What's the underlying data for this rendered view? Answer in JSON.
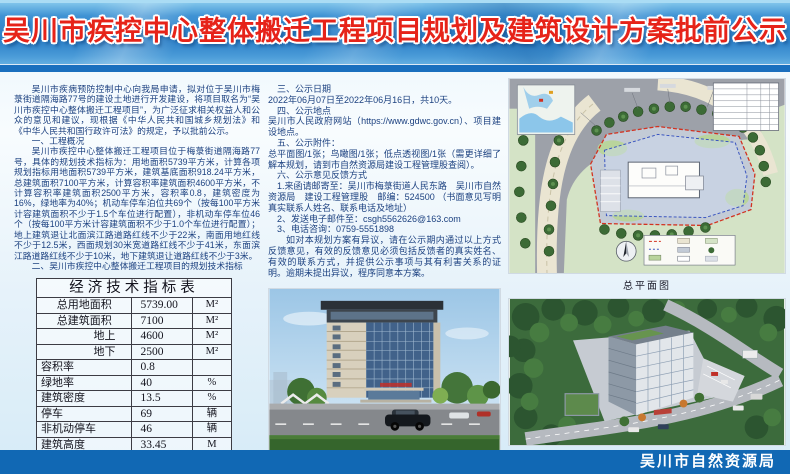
{
  "header": {
    "title": "吴川市疾控中心整体搬迁工程项目规划及建筑设计方案批前公示"
  },
  "left": {
    "intro": "吴川市疾病预防控制中心向我局申请，拟对位于吴川市梅菉街道隔海路77号的建设土地进行开发建设，将项目取名为“吴川市疾控中心整体搬迁工程项目”，为广泛征求相关权益人和公众的意见和建议，现根据《中华人民共和国城乡规划法》和《中华人民共和国行政许可法》的规定，予以批前公示。",
    "s1_heading": "一、工程概况",
    "s1_body": "吴川市疾控中心整体搬迁工程项目位于梅菉街道隔海路77号，具体的规划技术指标为：用地面积5739平方米，计算各项规划指标用地面积5739平方米，建筑基底面积918.24平方米，总建筑面积7100平方米，计算容积率建筑面积4600平方米，不计算容积率建筑面积2500平方米，容积率0.8，建筑密度为16%，绿地率为40%；机动车停车泊位共69个（按每100平方米计容建筑面积不少于1.5个车位进行配置），非机动车停车位46个（按每100平方米计容建筑面积不少于1.0个车位进行配置）；地上建筑退让北面滨江路道路红线不少于22米，南面用地红线不少于12.5米，西面规划30米宽道路红线不少于41米，东面滨江路道路红线不少于10米，地下建筑退让道路红线不少于3米。",
    "s2_heading": "二、吴川市疾控中心整体搬迁工程项目的规划技术指标",
    "table": {
      "title": "经济技术指标表",
      "rows": [
        {
          "label": "总用地面积",
          "value": "5739.00",
          "unit": "M²"
        },
        {
          "label": "总建筑面积",
          "value": "7100",
          "unit": "M²"
        },
        {
          "label": "地上",
          "value": "4600",
          "unit": "M²"
        },
        {
          "label": "地下",
          "value": "2500",
          "unit": "M²"
        },
        {
          "label": "容积率",
          "value": "0.8",
          "unit": ""
        },
        {
          "label": "绿地率",
          "value": "40",
          "unit": "%"
        },
        {
          "label": "建筑密度",
          "value": "13.5",
          "unit": "%"
        },
        {
          "label": "停车",
          "value": "69",
          "unit": "辆"
        },
        {
          "label": "非机动停车",
          "value": "46",
          "unit": "辆"
        },
        {
          "label": "建筑高度",
          "value": "33.45",
          "unit": "M"
        }
      ]
    }
  },
  "middle": {
    "s3_heading": "三、公示日期",
    "s3_body": "2022年06月07日至2022年06月16日，共10天。",
    "s4_heading": "四、公示地点",
    "s4_body": "吴川市人民政府网站（https://www.gdwc.gov.cn）、项目建设地点。",
    "s5_heading": "五、公示附件：",
    "s5_body": "总平面图/1张；鸟瞰图/1张；低点透视图/1张（需更详细了解本规划，请到市自然资源局建设工程管理股查阅）。",
    "s6_heading": "六、公示意见反馈方式",
    "item1": "1.来函请邮寄至：吴川市梅菉街道人民东路　吴川市自然资源局　建设工程管理股　邮编：524500 （书面意见写明真实联系人姓名、联系电话及地址）",
    "item2": "2、发送电子邮件至：csgh5562626@163.com",
    "item3": "3、电话咨询：0759-5551898",
    "closing": "如对本规划方案有异议，请在公示期内通过以上方式反馈意见，有效的反馈意见必须包括反馈者的真实姓名、有效的联系方式，并提供公示事项与其有利害关系的证明。逾期未提出异议，程序同意本方案。"
  },
  "captions": {
    "site_plan": "总平面图",
    "perspective": "低点透视图",
    "aerial": "鸟瞰图"
  },
  "footer": {
    "agency": "吴川市自然资源局"
  },
  "colors": {
    "banner_blue": "#2b7ec6",
    "banner_dark_strip": "#1a6fbe",
    "title_red": "#e62319",
    "body_text": "#1c4180",
    "footer_blue": "#1168b4",
    "boundary_red": "#d23220",
    "setback_blue": "#3a55c0"
  }
}
